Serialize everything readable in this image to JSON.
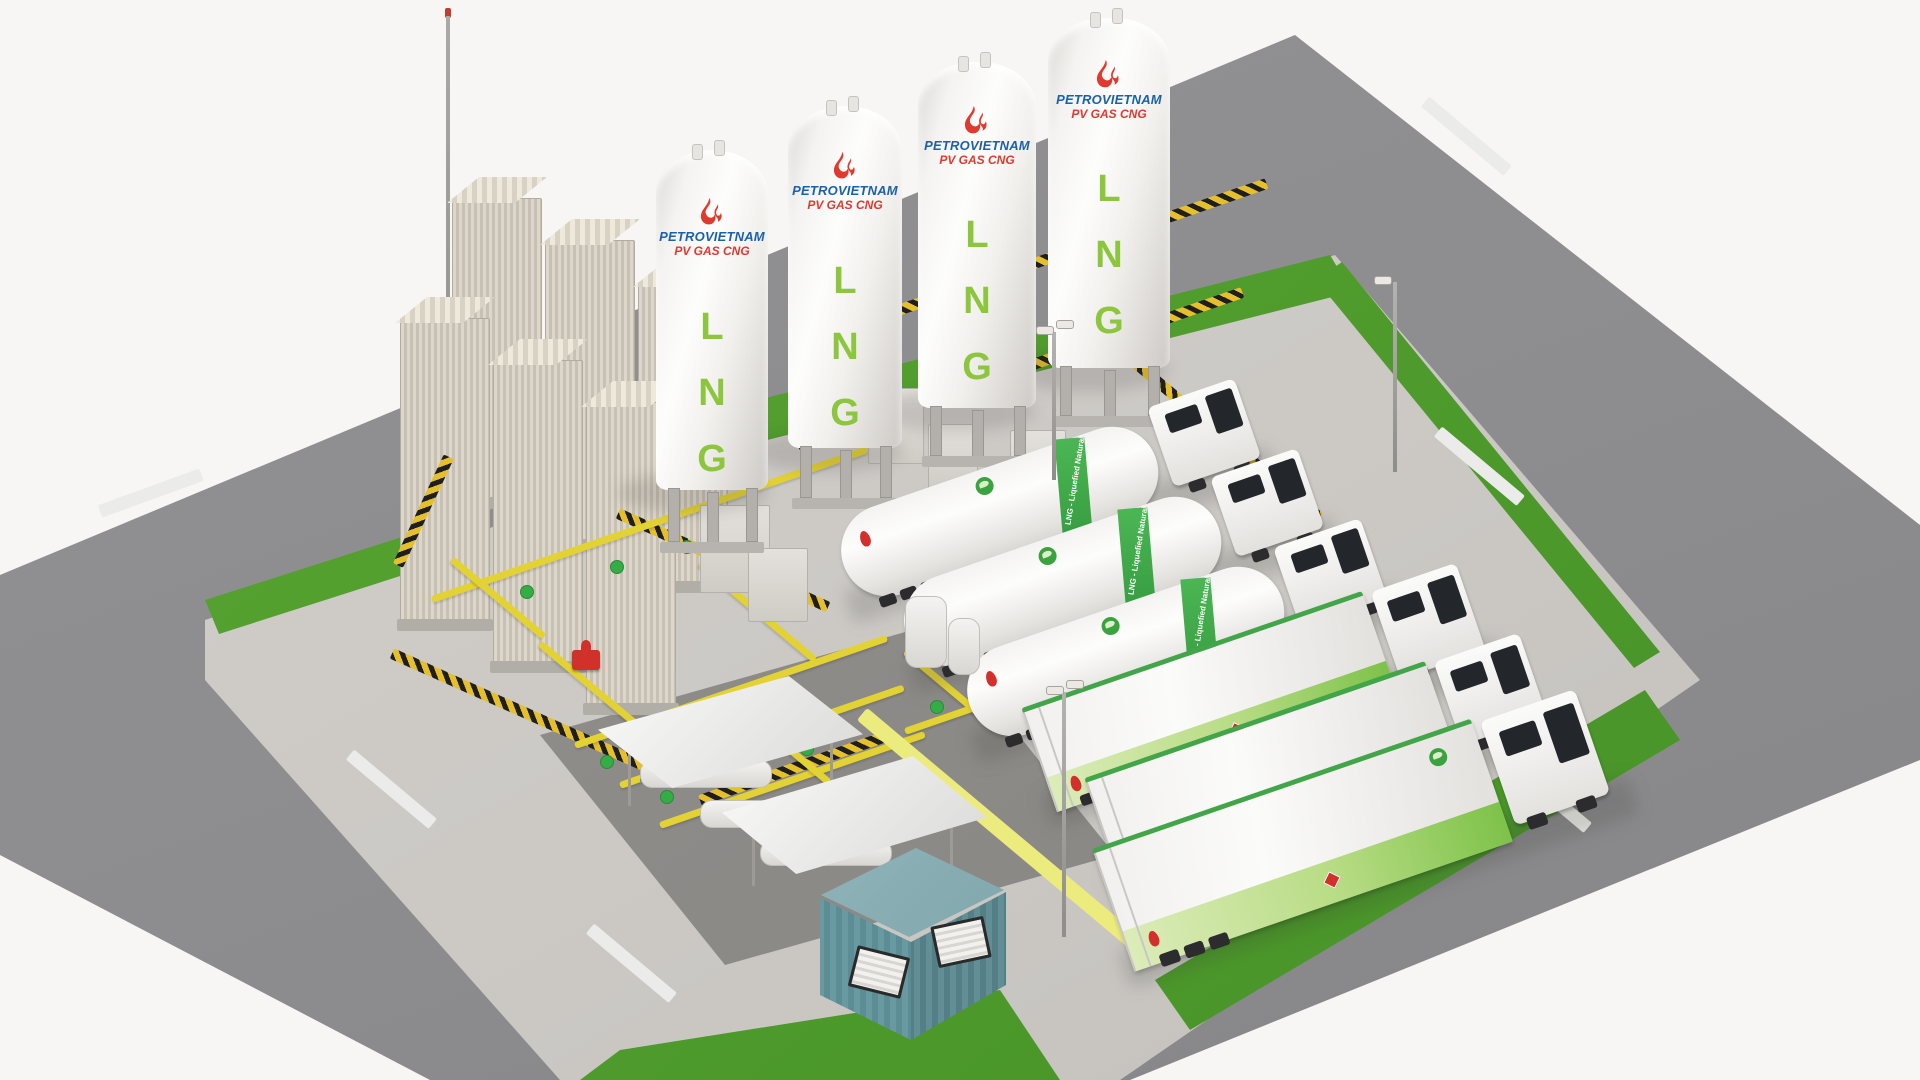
{
  "scene": {
    "description_label": "LNG satellite station 3D render",
    "counts": {
      "storage_tanks": 4,
      "vaporizer_columns": 6,
      "tanker_trucks": 3,
      "box_trucks": 3
    }
  },
  "branding": {
    "company": "PETROVIETNAM",
    "division": "PV GAS CNG",
    "product_letters": [
      "L",
      "N",
      "G"
    ]
  },
  "vehicles": {
    "tanker_band_label": "LNG - Liquefied Natural Gas"
  },
  "colors": {
    "brand_blue": "#1a61ab",
    "brand_red": "#e0392e",
    "lng_green": "#8cc63e",
    "grass_green": "#4f9e2d",
    "safety_yellow": "#e6bf2d",
    "pipe_yellow": "#e3d233",
    "container_teal": "#6a9aa1",
    "road_gray": "#8d8d8f",
    "pad_gray": "#cbc8c4",
    "truck_stripe_green": "#7ec24a",
    "road_marking": "#ebebe9"
  }
}
